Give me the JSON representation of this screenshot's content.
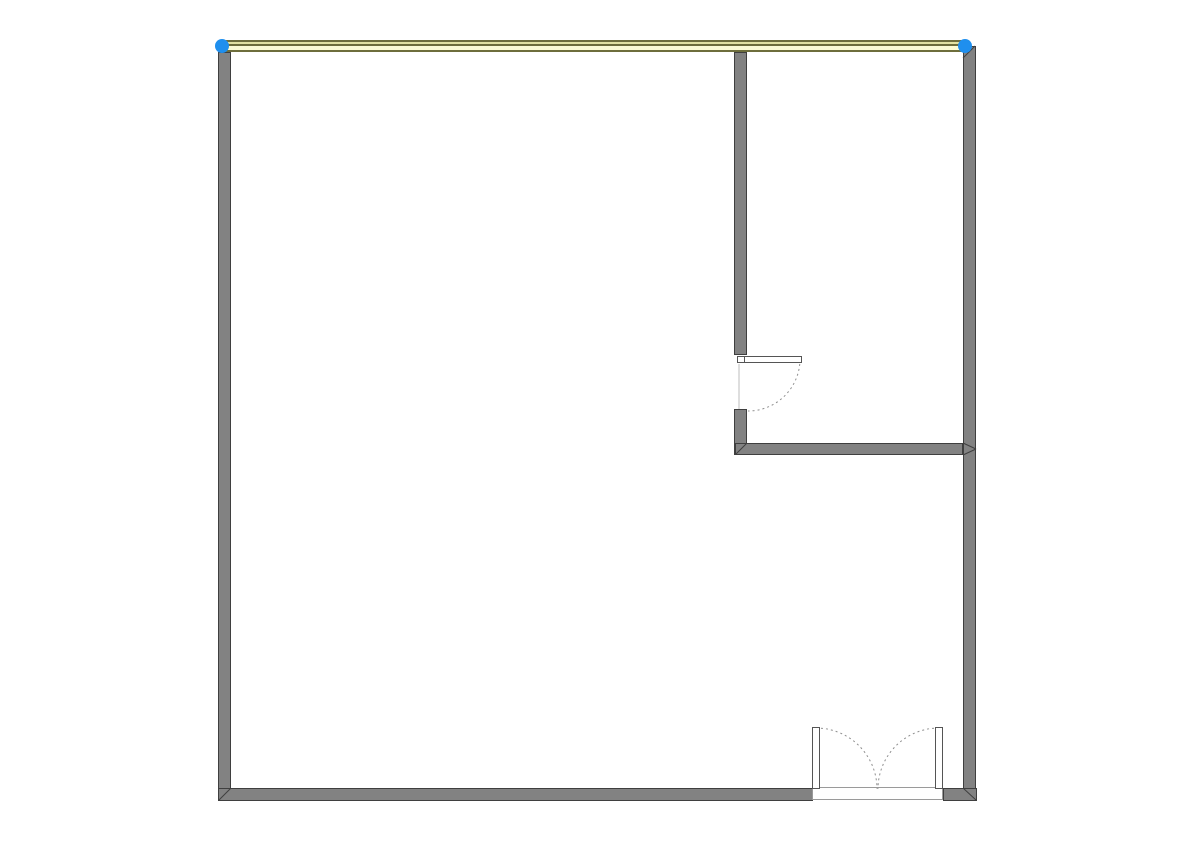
{
  "app": {
    "name": "floor-plan-editor-canvas",
    "canvas_width": 1190,
    "canvas_height": 841,
    "background": "#ffffff"
  },
  "palette": {
    "wall_fill": "#828282",
    "wall_edge": "#3f3f3f",
    "selected_stripe_dark": "#6e6e3c",
    "selected_stripe_light": "#e2e2a2",
    "selected_stripe_cream": "#fcfcd4",
    "handle_fill": "#1f8fee",
    "door_edge": "#555555",
    "door_fill": "#ffffff",
    "arc_color": "#8f8f8f",
    "threshold_edge": "#9a9a9a",
    "jamb_line": "#bdbdbd"
  },
  "walls": [
    {
      "id": "wall-left",
      "x": 218,
      "y": 52,
      "w": 13,
      "h": 749
    },
    {
      "id": "wall-right",
      "x": 963,
      "y": 46,
      "w": 13,
      "h": 755
    },
    {
      "id": "wall-bottom-left-of-door",
      "x": 218,
      "y": 788,
      "w": 595,
      "h": 13
    },
    {
      "id": "wall-bottom-right-of-door",
      "x": 943,
      "y": 788,
      "w": 34,
      "h": 13
    },
    {
      "id": "wall-interior-vertical-upper",
      "x": 734,
      "y": 52,
      "w": 13,
      "h": 303
    },
    {
      "id": "wall-interior-vertical-lower",
      "x": 734,
      "y": 409,
      "w": 13,
      "h": 46
    },
    {
      "id": "wall-interior-horizontal",
      "x": 735,
      "y": 443,
      "w": 228,
      "h": 12
    }
  ],
  "selected_wall": {
    "id": "wall-top-selected",
    "x": 222,
    "y": 40,
    "w": 743,
    "h": 12,
    "stripes": [
      {
        "offset": 0,
        "h": 2,
        "color_key": "selected_stripe_dark"
      },
      {
        "offset": 2,
        "h": 2,
        "color_key": "selected_stripe_light"
      },
      {
        "offset": 4,
        "h": 2,
        "color_key": "selected_stripe_dark"
      },
      {
        "offset": 6,
        "h": 4,
        "color_key": "selected_stripe_cream"
      },
      {
        "offset": 10,
        "h": 2,
        "color_key": "selected_stripe_dark"
      }
    ],
    "handles": [
      {
        "id": "wall-endpoint-handle-left",
        "cx": 222,
        "cy": 46,
        "r": 7
      },
      {
        "id": "wall-endpoint-handle-right",
        "cx": 965,
        "cy": 46,
        "r": 7
      }
    ]
  },
  "miters": [
    {
      "id": "miter-bottom-left",
      "x1": 219,
      "y1": 800,
      "x2": 231,
      "y2": 788
    },
    {
      "id": "miter-bottom-right",
      "x1": 963,
      "y1": 788,
      "x2": 976,
      "y2": 800
    },
    {
      "id": "miter-interior-corner",
      "x1": 736,
      "y1": 454,
      "x2": 747,
      "y2": 443
    },
    {
      "id": "miter-tjunction-upper",
      "x1": 963,
      "y1": 443,
      "x2": 976,
      "y2": 449
    },
    {
      "id": "miter-tjunction-lower",
      "x1": 963,
      "y1": 455,
      "x2": 976,
      "y2": 449
    },
    {
      "id": "miter-top-right",
      "x1": 963,
      "y1": 58,
      "x2": 975,
      "y2": 46
    }
  ],
  "doors": {
    "single": {
      "id": "single-door-interior",
      "panel": {
        "x": 737,
        "y": 356,
        "w": 65,
        "h": 7
      },
      "hinge_block": {
        "x": 737,
        "y": 356,
        "w": 8,
        "h": 7
      },
      "arc": {
        "d": "M 800 359 A 52 52 0 0 1 748 411"
      },
      "jamb": {
        "x1": 739,
        "y1": 364,
        "x2": 739,
        "y2": 409
      }
    },
    "double": {
      "id": "double-door-entry",
      "threshold": {
        "x": 812,
        "y": 787,
        "w": 131,
        "h": 13
      },
      "left_panel": {
        "x": 812,
        "y": 727,
        "w": 8,
        "h": 62
      },
      "right_panel": {
        "x": 935,
        "y": 727,
        "w": 8,
        "h": 62
      },
      "left_arc": {
        "d": "M 816 728 A 61 61 0 0 1 877 789"
      },
      "right_arc": {
        "d": "M 939 728 A 61 61 0 0 0 878 789"
      }
    }
  }
}
